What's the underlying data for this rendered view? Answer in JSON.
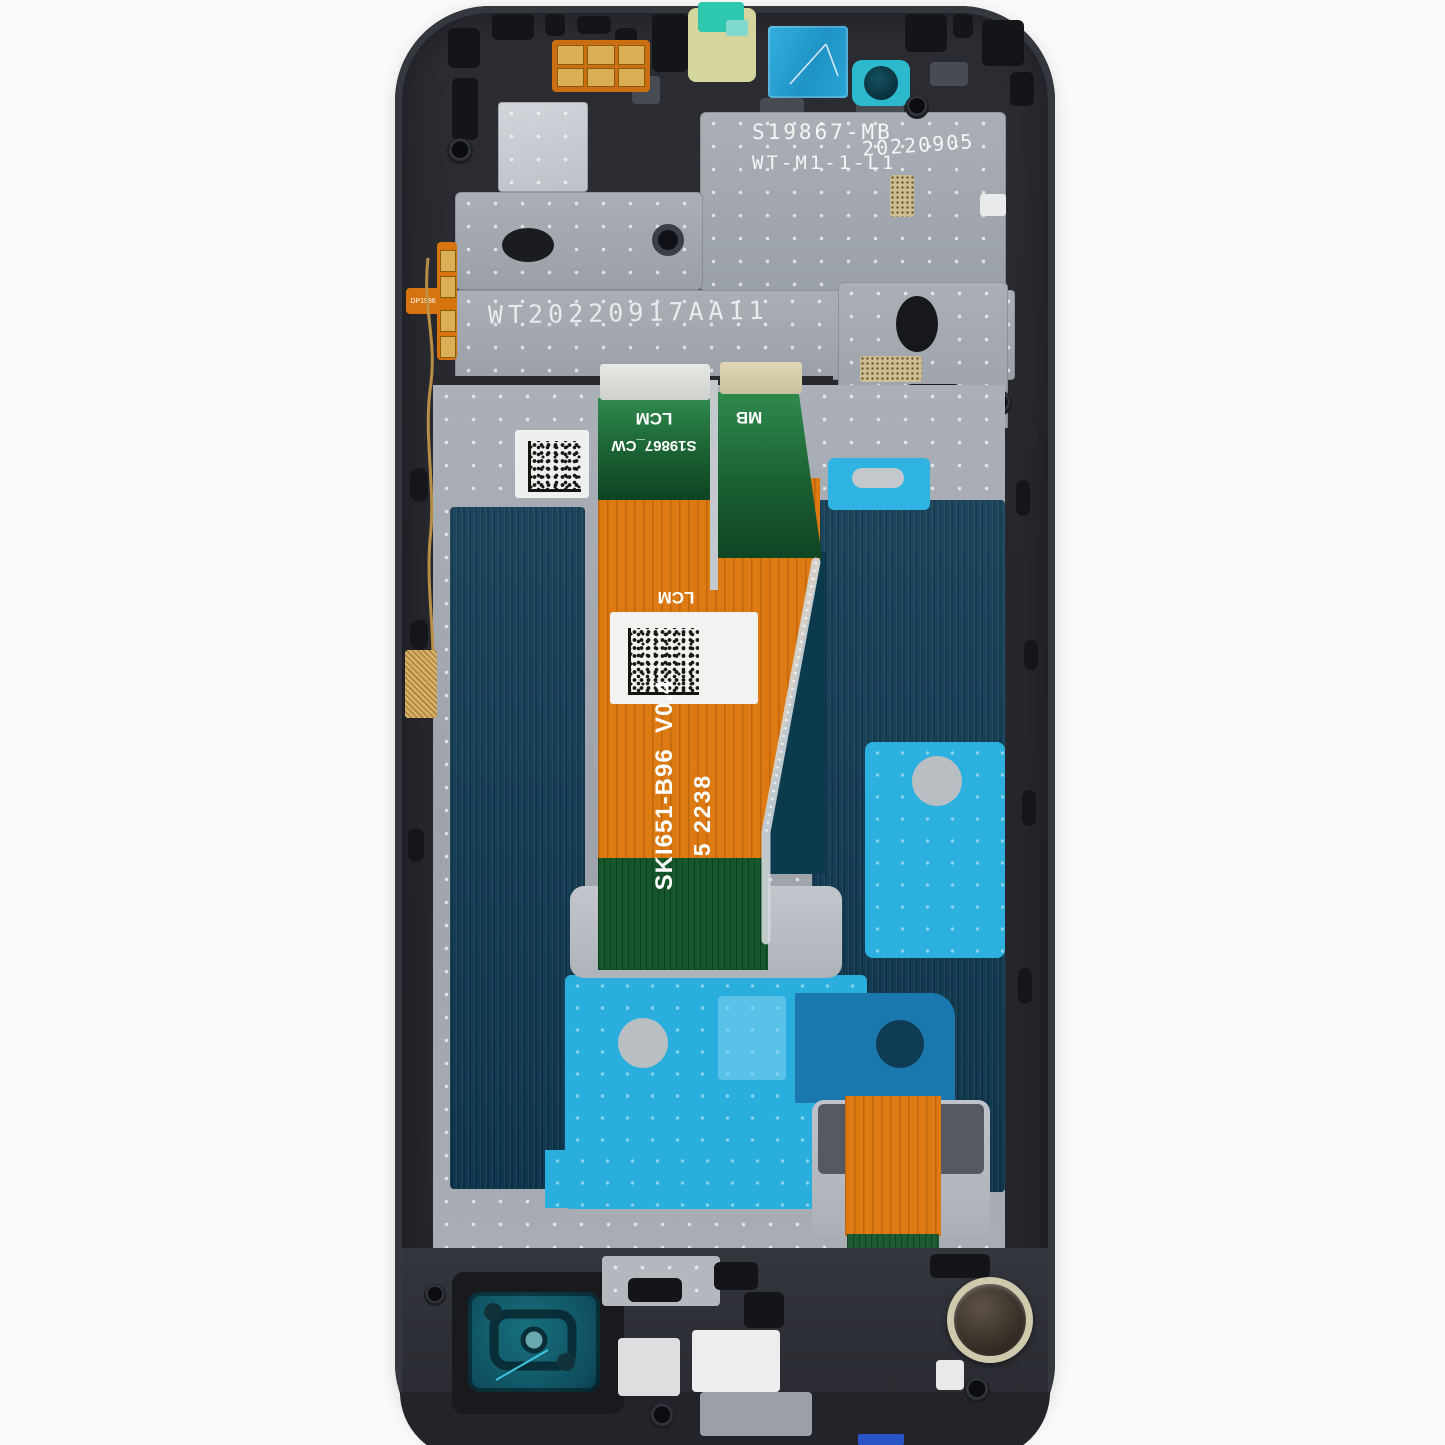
{
  "image": {
    "type": "product-photo",
    "subject": "Smartphone LCD display assembly with mid-frame, internal rear view with flex cables and adhesives",
    "background": "#fafafa"
  },
  "markings": {
    "shield_model": "S19867-MB",
    "shield_code": "WT-M1-1-L1",
    "shield_date": "20220905",
    "etched_serial": "WT20220917AA11"
  },
  "flex": {
    "lcm_connector_label": "LCM",
    "lcm_serial": "S19867_CW",
    "mb_connector_label": "MB",
    "lcm_mid_label": "LCM",
    "part_number": "SKI651-B96  V0.4",
    "batch_code": "5 2238",
    "side_flex_code": "DP1986"
  },
  "colors": {
    "frame": "#2b2d33",
    "metal_plate": "#a6abb3",
    "navy_panel": "#113d56",
    "cyan_adhesive": "#2aaede",
    "dark_blue_adhesive": "#1b78ae",
    "orange_flex": "#dd7a12",
    "green_flex": "#1e6f3c",
    "teal_sticker": "#2db9cd",
    "blue_sticker": "#2aa4d6",
    "yellow_sticker": "#d4d69e",
    "gold": "#d9ae54",
    "background": "#fafafa"
  }
}
